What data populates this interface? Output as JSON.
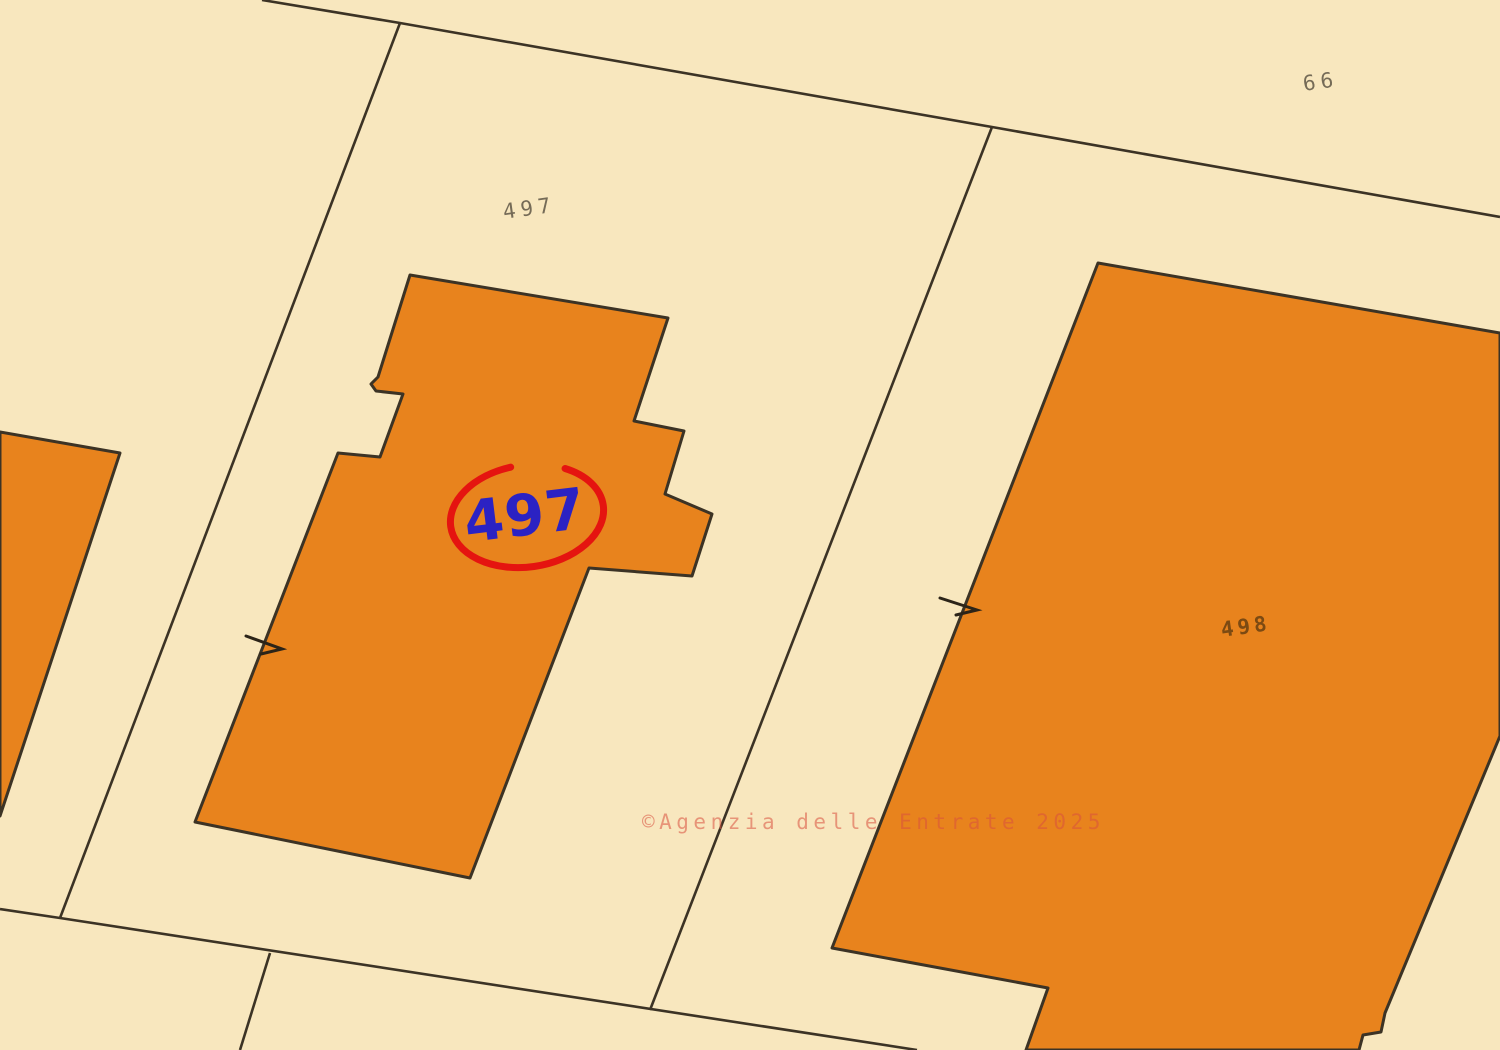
{
  "map": {
    "type": "cadastral-map-view",
    "watermark_text": "©Agenzia delle Entrate 2025"
  },
  "parcels": {
    "p497": {
      "label": "497"
    },
    "p66": {
      "label": "66"
    },
    "p498": {
      "label": "498"
    }
  },
  "highlight": {
    "parcel_number": "497",
    "style": "blue number circled in red"
  },
  "colors": {
    "background_cream": "#F8E7BE",
    "building_orange": "#E8831D",
    "boundary_stroke": "#3C3325",
    "parcel_label_gray": "#756B57",
    "building_label_brown": "#7C4A12",
    "highlight_blue": "#2B22C3",
    "highlight_red": "#E51410",
    "watermark_salmon": "#D9503E"
  }
}
